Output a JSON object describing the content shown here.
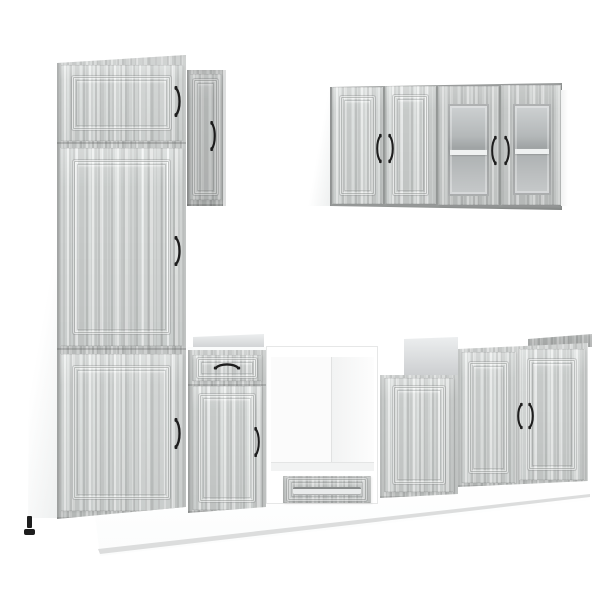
{
  "scene": {
    "description": "Product photo of a modular kitchen cabinet set in grey Sonoma oak wood finish with black bow handles and white carcass panels on a plain white background",
    "background_color": "#ffffff"
  },
  "palette": {
    "wood_base": "#c6c9c8",
    "wood_light": "#dbdddc",
    "wood_dark": "#aeb1b0",
    "wood_deep": "#9a9d9c",
    "carcass_white": "#ffffff",
    "back_panel_top": "#eceeef",
    "back_panel_bottom": "#ccced0",
    "glass_light": "#cfd2d3",
    "glass_dark": "#9fa3a4",
    "handle_black": "#1e1e1e",
    "plinth_edge": "#dcdddd"
  },
  "units": [
    {
      "id": "tall-pantry-cabinet",
      "label": "Tall pantry cabinet with three panelled doors"
    },
    {
      "id": "narrow-wall-cabinet",
      "label": "Narrow wall cabinet with single panelled door"
    },
    {
      "id": "upper-wall-cabinet",
      "label": "Wall cabinet with two panelled doors and two frosted glass doors"
    },
    {
      "id": "drawer-base-cabinet",
      "label": "Base cabinet with top drawer and panelled door"
    },
    {
      "id": "oven-housing-cabinet",
      "label": "Open oven housing cabinet with bottom drawer"
    },
    {
      "id": "single-door-base-cabinet",
      "label": "Base cabinet with single panelled door and open top"
    },
    {
      "id": "double-door-base-cabinet",
      "label": "Base cabinet with two panelled doors"
    },
    {
      "id": "plinth",
      "label": "White plinth base under the cabinets"
    }
  ]
}
